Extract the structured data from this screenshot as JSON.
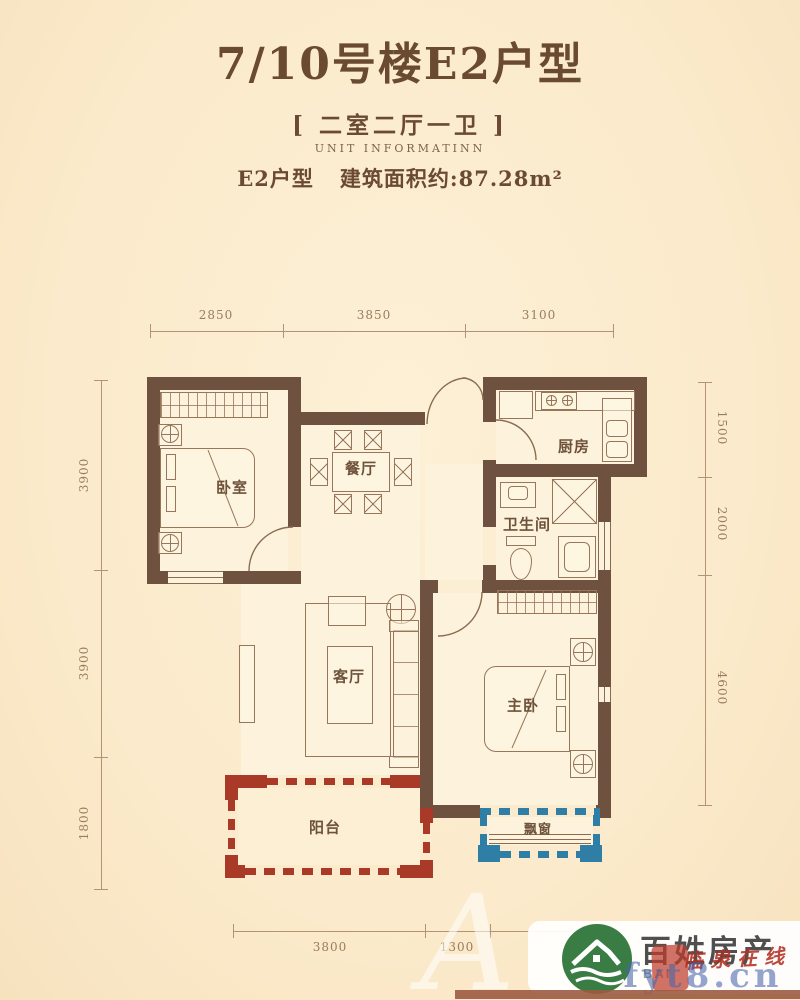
{
  "title": "7/10号楼E2户型",
  "subtitle": "[ 二室二厅一卫 ]",
  "subtitle_en": "UNIT INFORMATINN",
  "unit_label": "E2户型",
  "area_label": "建筑面积约:87.28m²",
  "rooms": {
    "bedroom": "卧室",
    "dining": "餐厅",
    "kitchen": "厨房",
    "bathroom": "卫生间",
    "living": "客厅",
    "master": "主卧",
    "balcony": "阳台",
    "bay_window": "飘窗"
  },
  "dimensions": {
    "top": [
      "2850",
      "3850",
      "3100"
    ],
    "left": [
      "3900",
      "3900",
      "1800"
    ],
    "right": [
      "1500",
      "2000",
      "4600"
    ],
    "bottom": [
      "3800",
      "1300"
    ]
  },
  "watermark": {
    "brand": "百姓房产",
    "brand_sub": "BAI",
    "overlay_red": "临泉在线",
    "overlay_blue": "fyt8.cn",
    "ghost_letter": "A"
  },
  "colors": {
    "wall": "#6F5140",
    "balcony_red": "#A93A28",
    "bay_blue": "#2E7EA5",
    "background": "#FBEACB",
    "logo_green": "#3A7D44"
  }
}
